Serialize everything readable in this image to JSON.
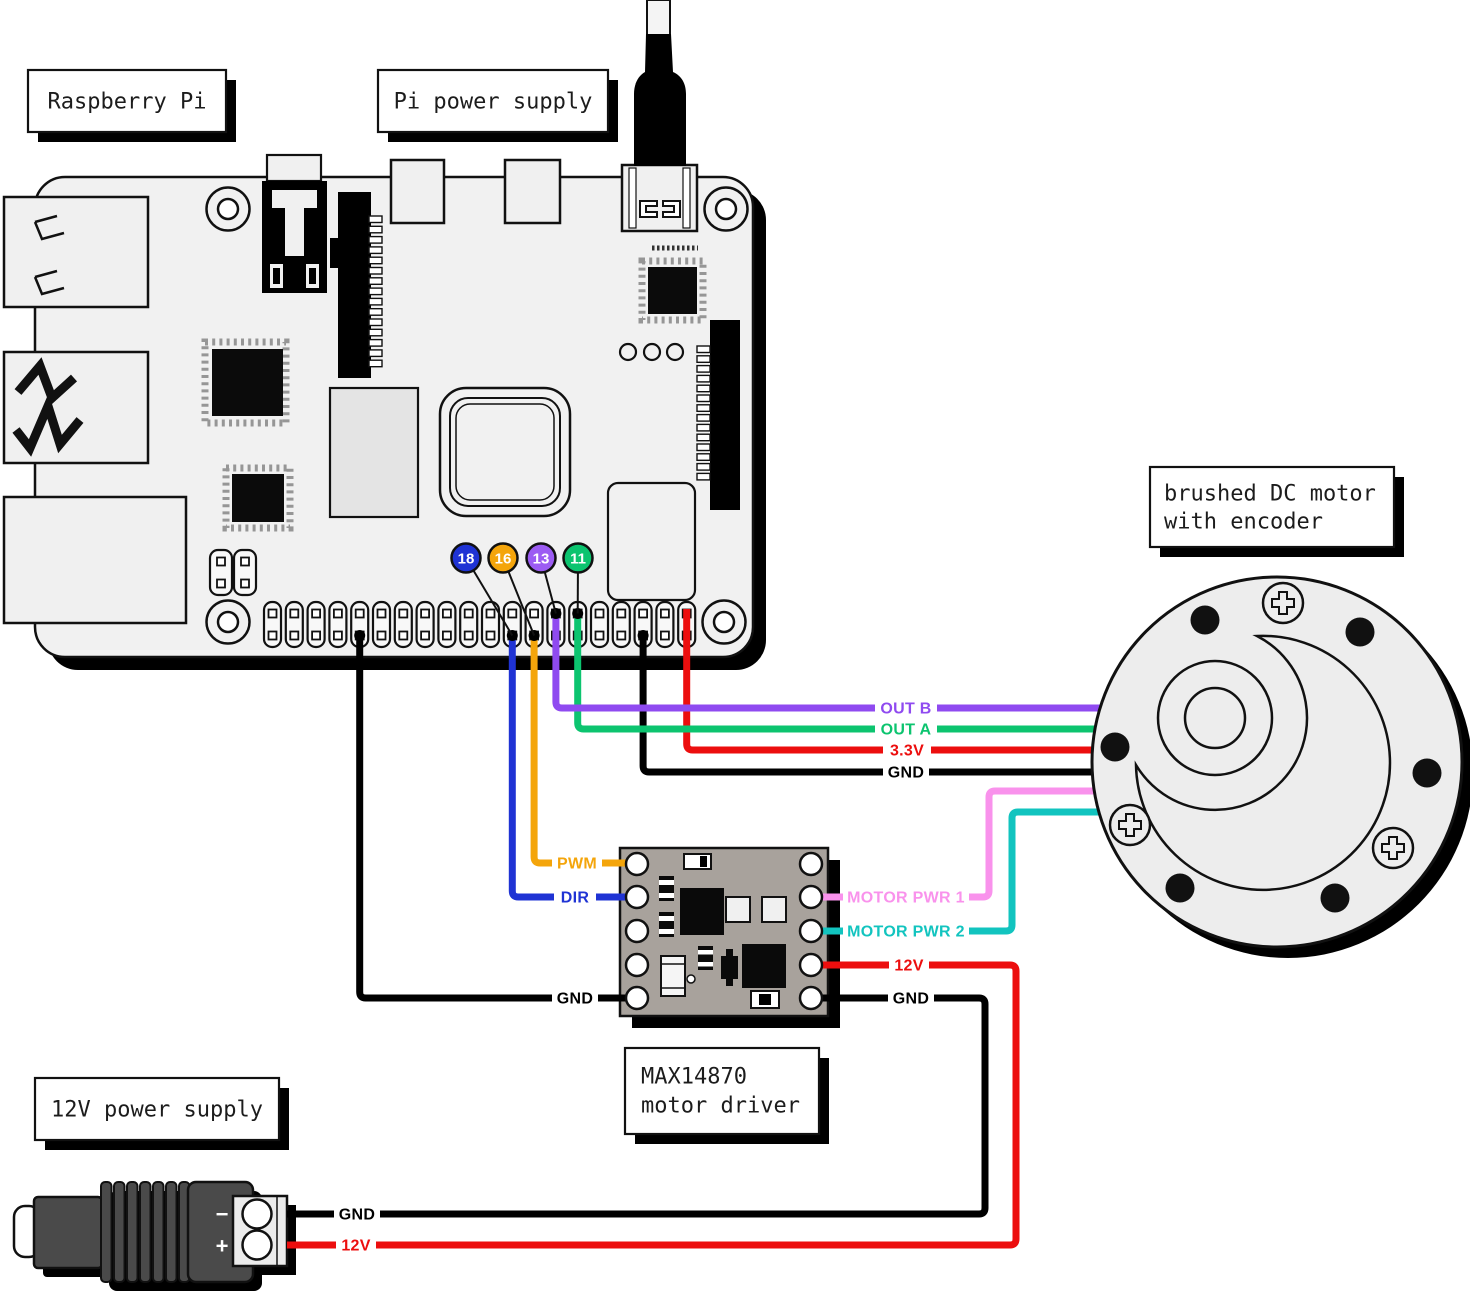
{
  "boxes": {
    "raspberry_pi": "Raspberry Pi",
    "pi_power_supply": "Pi power supply",
    "dc_motor_line1": "brushed DC motor",
    "dc_motor_line2": "with encoder",
    "driver_line1": "MAX14870",
    "driver_line2": "motor driver",
    "supply_12v": "12V power supply"
  },
  "gpio_badges": [
    {
      "pin": "18",
      "color": "#1f33d4"
    },
    {
      "pin": "16",
      "color": "#f4a50b"
    },
    {
      "pin": "13",
      "color": "#9c5cf3"
    },
    {
      "pin": "11",
      "color": "#0cc46f"
    }
  ],
  "wires": {
    "out_b": {
      "label": "OUT B",
      "color": "#8f4af0"
    },
    "out_a": {
      "label": "OUT A",
      "color": "#0cc46f"
    },
    "v3_3": {
      "label": "3.3V",
      "color": "#ec0e0e"
    },
    "gnd_encoder": {
      "label": "GND",
      "color": "#000000"
    },
    "pwm": {
      "label": "PWM",
      "color": "#f4a50b"
    },
    "dir": {
      "label": "DIR",
      "color": "#1f33d4"
    },
    "gnd_logic": {
      "label": "GND",
      "color": "#000000"
    },
    "motor_pwr_1": {
      "label": "MOTOR PWR 1",
      "color": "#f992ec"
    },
    "motor_pwr_2": {
      "label": "MOTOR PWR 2",
      "color": "#12c4bf"
    },
    "v12": {
      "label": "12V",
      "color": "#ec0e0e"
    },
    "gnd_power": {
      "label": "GND",
      "color": "#000000"
    },
    "supply_gnd": {
      "label": "GND",
      "color": "#000000"
    },
    "supply_12v": {
      "label": "12V",
      "color": "#ec0e0e"
    }
  },
  "terminal": {
    "negative": "−",
    "positive": "+"
  }
}
